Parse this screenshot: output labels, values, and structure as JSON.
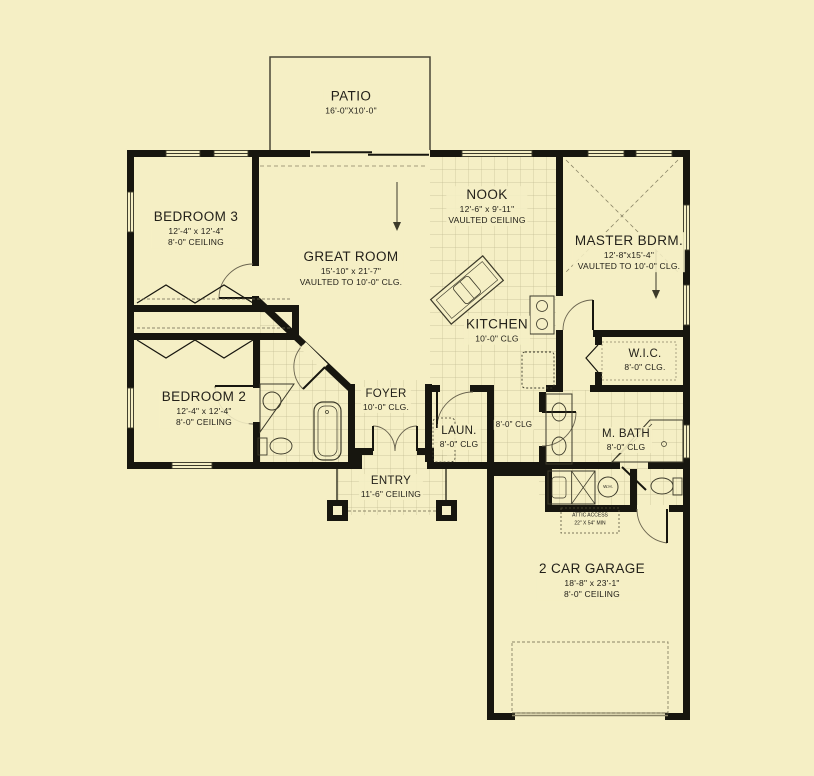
{
  "title": "Single-story house floor plan",
  "colors": {
    "background": "#F5EFC5",
    "wall": "#17160f",
    "line": "#3c3a2a",
    "dash": "#8a8466",
    "tile": "#8f8a63"
  },
  "rooms": {
    "patio": {
      "name": "PATIO",
      "dims": "16'-0\"X10'-0\""
    },
    "nook": {
      "name": "NOOK",
      "dims": "12'-6\" x 9'-11\"",
      "ceiling": "VAULTED CEILING"
    },
    "bedroom3": {
      "name": "BEDROOM 3",
      "dims": "12'-4\" x 12'-4\"",
      "ceiling": "8'-0\" CEILING"
    },
    "master": {
      "name": "MASTER BDRM.",
      "dims": "12'-8\"x15'-4\"",
      "ceiling": "VAULTED TO 10'-0\" CLG."
    },
    "great_room": {
      "name": "GREAT ROOM",
      "dims": "15'-10\" x 21'-7\"",
      "ceiling": "VAULTED TO 10'-0\" CLG."
    },
    "kitchen": {
      "name": "KITCHEN",
      "ceiling": "10'-0\" CLG"
    },
    "wic": {
      "name": "W.I.C.",
      "ceiling": "8'-0\" CLG."
    },
    "bedroom2": {
      "name": "BEDROOM 2",
      "dims": "12'-4\" x 12'-4\"",
      "ceiling": "8'-0\" CEILING"
    },
    "foyer": {
      "name": "FOYER",
      "ceiling": "10'-0\" CLG."
    },
    "laundry": {
      "name": "LAUN.",
      "ceiling": "8'-0\" CLG"
    },
    "hall": {
      "ceiling": "8'-0\" CLG"
    },
    "master_bath": {
      "name": "M. BATH",
      "ceiling": "8'-0\" CLG"
    },
    "entry": {
      "name": "ENTRY",
      "ceiling": "11'-6\" CEILING"
    },
    "garage": {
      "name": "2 CAR GARAGE",
      "dims": "18'-8\" x 23'-1\"",
      "ceiling": "8'-0\" CEILING"
    }
  },
  "notes": {
    "attic_access_line1": "ATTIC ACCESS",
    "attic_access_line2": "22\" X 54\" MIN",
    "water_heater": "W.H."
  }
}
